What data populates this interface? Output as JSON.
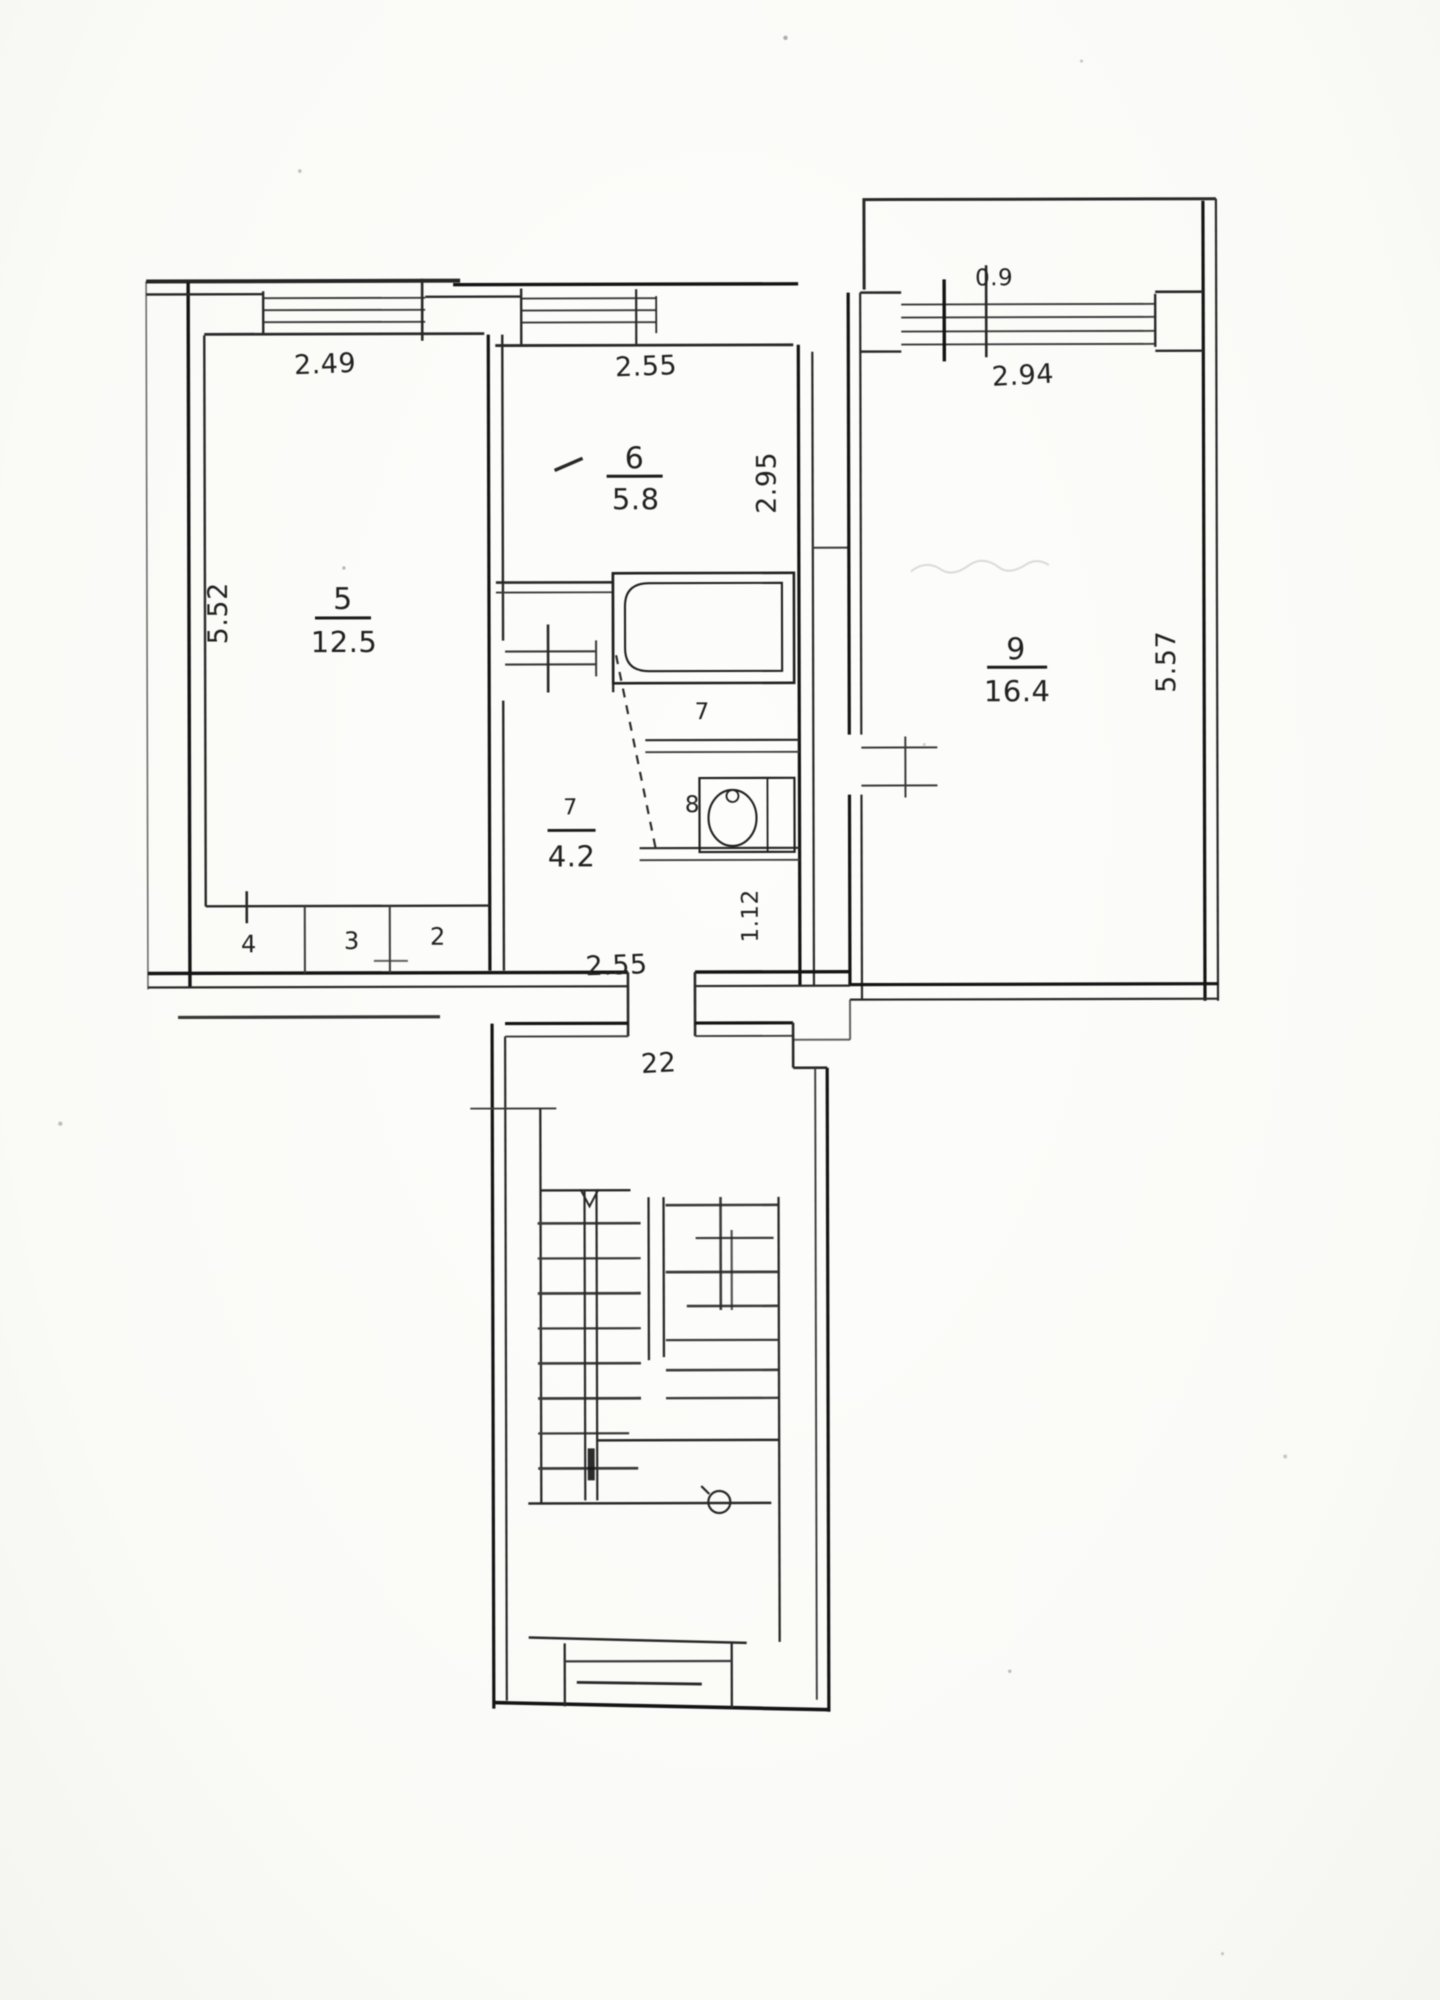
{
  "document": {
    "type": "scanned floor plan",
    "paper_color": "#fcfcfa",
    "ink_color": "#1f1f1f"
  },
  "apartment": {
    "entrance_label": "22",
    "rooms": [
      {
        "key": "room-5",
        "number": "5",
        "area": "12.5"
      },
      {
        "key": "room-6",
        "number": "6",
        "area": "5.8"
      },
      {
        "key": "room-7-hall",
        "number": "7",
        "area": "4.2"
      },
      {
        "key": "room-9",
        "number": "9",
        "area": "16.4"
      }
    ],
    "wet_rooms": [
      {
        "key": "bathroom",
        "number": "7"
      },
      {
        "key": "toilet",
        "number": "8"
      }
    ],
    "closets": [
      {
        "key": "closet-a",
        "number": "4"
      },
      {
        "key": "closet-b",
        "number": "3"
      },
      {
        "key": "closet-c",
        "number": "2"
      }
    ]
  },
  "dimensions": {
    "room5_width_top": "2.49",
    "room5_depth_left": "5.52",
    "room6_width_top": "2.55",
    "room6_depth_right": "2.95",
    "room9_window_leaf": "0.9",
    "room9_width_top": "2.94",
    "room9_depth_right": "5.57",
    "hall_width_bottom": "2.55",
    "toilet_depth_right": "1.12"
  },
  "icons": {
    "bathtub": "bathtub-icon",
    "washbasin": "washbasin-icon",
    "stairs": "stair-flight-icon",
    "door_swing": "door-swing-icon",
    "windows": "window-icon"
  }
}
